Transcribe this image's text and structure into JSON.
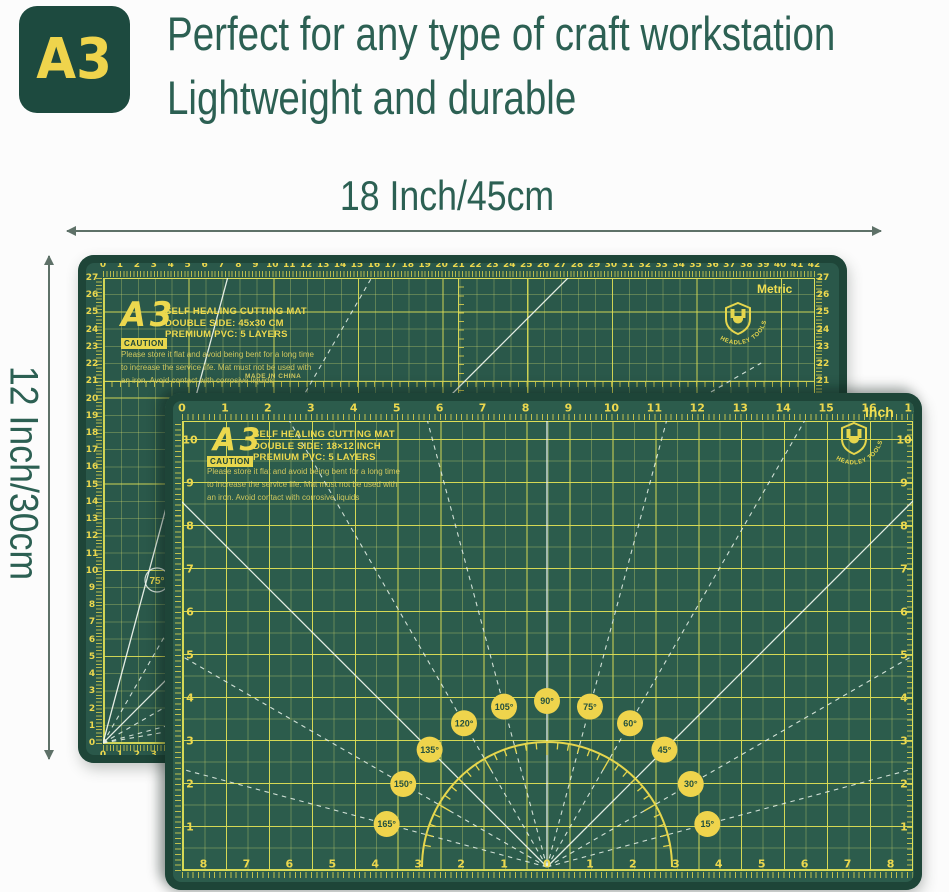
{
  "header": {
    "badge_label": "A3",
    "title_line1": "Perfect for any type of craft workstation",
    "title_line2": "Lightweight and durable"
  },
  "annotations": {
    "width_label": "18 Inch/45cm",
    "height_label": "12 Inch/30cm"
  },
  "brand": "HEADLEY TOOLS",
  "colors": {
    "page_bg": "#fcfcfc",
    "header_text": "#2c6053",
    "badge_bg": "#1d4a3f",
    "badge_text": "#efd44c",
    "arrow": "#5e7168",
    "mat_field_back": "#2a584a",
    "mat_field_front": "#2c5c4c",
    "mat_edge": "#1e4538",
    "grid_bright": "#dbdc55",
    "ruler_text": "#ecd84e",
    "caution_bg": "#e8d74d",
    "info_dim": "#cfc75e",
    "white_line": "#e8f2e6",
    "angle_badge_bg": "#efd44c",
    "angle_badge_text": "#23503f"
  },
  "back_mat": {
    "side_label": "Metric",
    "size_title": "A3",
    "spec_lines": [
      "SELF HEALING CUTTING MAT",
      "DOUBLE SIDE: 45x30 CM",
      "PREMIUM PVC: 5 LAYERS"
    ],
    "caution_label": "CAUTION",
    "caution_lines": [
      "Please store it flat and avoid being bent for a  long time",
      "to increase the service  life. Mat must not be used with",
      "an iron. Avoid contact with corrosive liquids"
    ],
    "made_in": "MADE IN CHINA",
    "ruler_unit": "cm",
    "top_ruler_max": 42,
    "side_ruler_max": 27,
    "fan_angles": [
      {
        "deg": 10,
        "dashed": true
      },
      {
        "deg": 15,
        "dashed": true
      },
      {
        "deg": 30,
        "dashed": true
      },
      {
        "deg": 45,
        "dashed": false
      },
      {
        "deg": 60,
        "dashed": true
      },
      {
        "deg": 75,
        "dashed": false
      }
    ],
    "fan_label": "75°"
  },
  "front_mat": {
    "side_label": "Inch",
    "size_title": "A3",
    "spec_lines": [
      "SELF HEALING CUTTING MAT",
      "DOUBLE SIDE: 18×12 INCH",
      "PREMIUM PVC: 5 LAYERS"
    ],
    "caution_label": "CAUTION",
    "caution_lines": [
      "Please store it flat and avoid being bent for a  long time",
      "to increase the service  life. Mat must not be used with",
      "an iron. Avoid contact with corrosive liquids"
    ],
    "ruler_unit": "inch",
    "top_ruler_max": 17,
    "side_ruler_max": 10,
    "bottom_ruler_half": 8,
    "protractor_angles": [
      15,
      30,
      45,
      60,
      75,
      90,
      105,
      120,
      135,
      150,
      165
    ],
    "solid_angles": [
      45,
      90,
      135
    ]
  }
}
